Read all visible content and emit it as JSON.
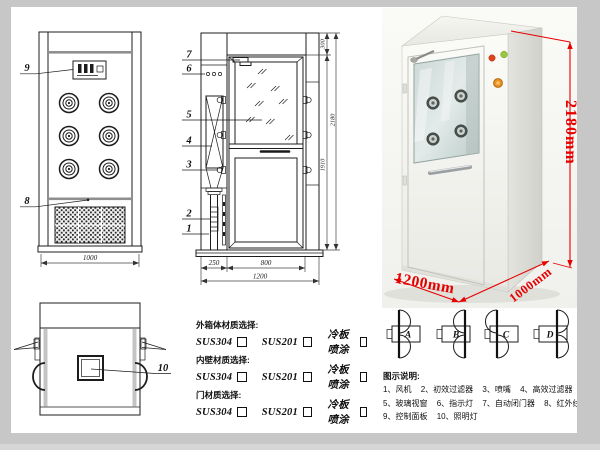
{
  "meta": {
    "description": "Air shower cleanroom unit technical drawing sheet"
  },
  "colors": {
    "line": "#1c1c1c",
    "dim_red": "#e60000",
    "frame_gray": "#c7c7c7"
  },
  "front_view": {
    "callout_control_panel": "9",
    "callout_sensor": "8",
    "dim_width": "1000"
  },
  "section_view": {
    "callout_door_closer": "7",
    "callout_indicator": "6",
    "callout_glass": "5",
    "callout_hepa": "4",
    "callout_nozzle": "3",
    "callout_prefilter": "2",
    "callout_fan": "1",
    "dim_top": "300",
    "dim_inner_height": "1910",
    "dim_total_height": "2180",
    "dim_side": "250",
    "dim_door": "800",
    "dim_width": "1200"
  },
  "top_view": {
    "callout_lamp": "10"
  },
  "photo": {
    "dim_height": "2180mm",
    "dim_width": "1200mm",
    "dim_depth": "1000mm"
  },
  "materials": {
    "groups": [
      {
        "title": "外箱体材质选择:",
        "options": [
          "SUS304",
          "SUS201",
          "冷板喷涂"
        ]
      },
      {
        "title": "内壁材质选择:",
        "options": [
          "SUS304",
          "SUS201",
          "冷板喷涂"
        ]
      },
      {
        "title": "门材质选择:",
        "options": [
          "SUS304",
          "SUS201",
          "冷板喷涂"
        ]
      }
    ]
  },
  "door_configs": {
    "labels": [
      "A",
      "B",
      "C",
      "D"
    ]
  },
  "legend": {
    "title": "图示说明:",
    "items": [
      "1、风机",
      "2、初效过滤器",
      "3、喷嘴",
      "4、高效过滤器",
      "5、玻璃视窗",
      "6、指示灯",
      "7、自动闭门器",
      "8、红外线感应器",
      "9、控制面板",
      "10、照明灯"
    ]
  }
}
